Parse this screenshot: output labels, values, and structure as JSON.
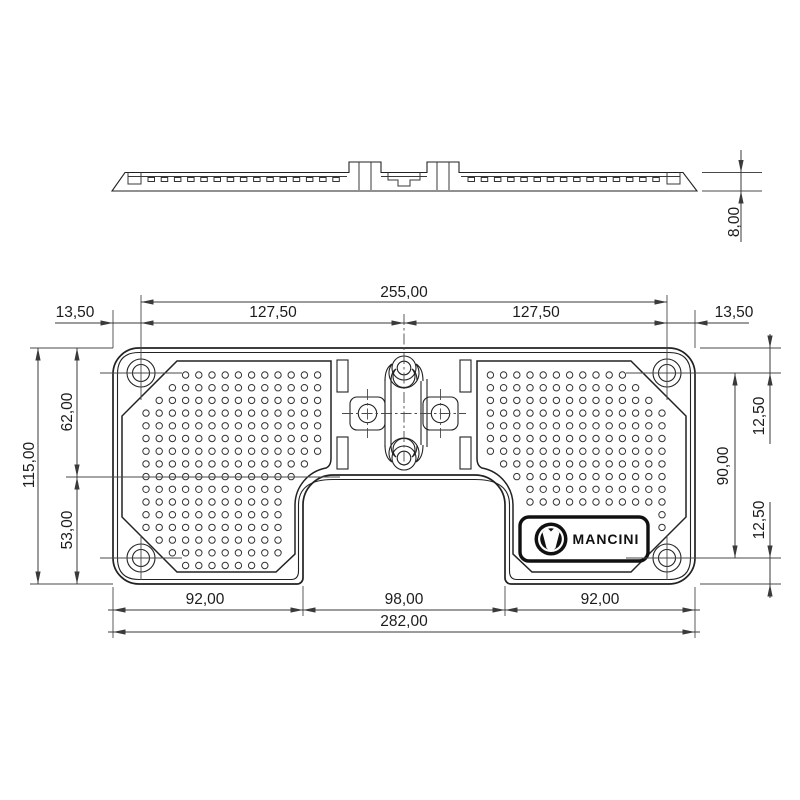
{
  "drawing": {
    "brand": {
      "name": "MANCINI",
      "logo_icon": "mancini-m-shield-icon"
    },
    "dimensions": {
      "top": {
        "holes_span": "255,00",
        "left_half": "127,50",
        "right_half": "127,50",
        "left_margin": "13,50",
        "right_margin": "13,50"
      },
      "left": {
        "overall_height": "115,00",
        "upper": "62,00",
        "lower": "53,00"
      },
      "right": {
        "top_hole_offset": "12,50",
        "hole_span": "90,00",
        "bottom_hole_offset": "12,50"
      },
      "bottom": {
        "left_tab": "92,00",
        "cutout_width": "98,00",
        "right_tab": "92,00",
        "overall_width": "282,00"
      },
      "side": {
        "thickness": "8,00"
      }
    },
    "colors": {
      "line": "#222222",
      "dimension": "#3a3a3a",
      "background": "#ffffff",
      "badge": "#101010"
    },
    "pads": {
      "dot_radius": 3.2,
      "dot_step_x": 13.2,
      "dot_step_y": 12.7,
      "rows": 16,
      "cols": 15
    }
  }
}
